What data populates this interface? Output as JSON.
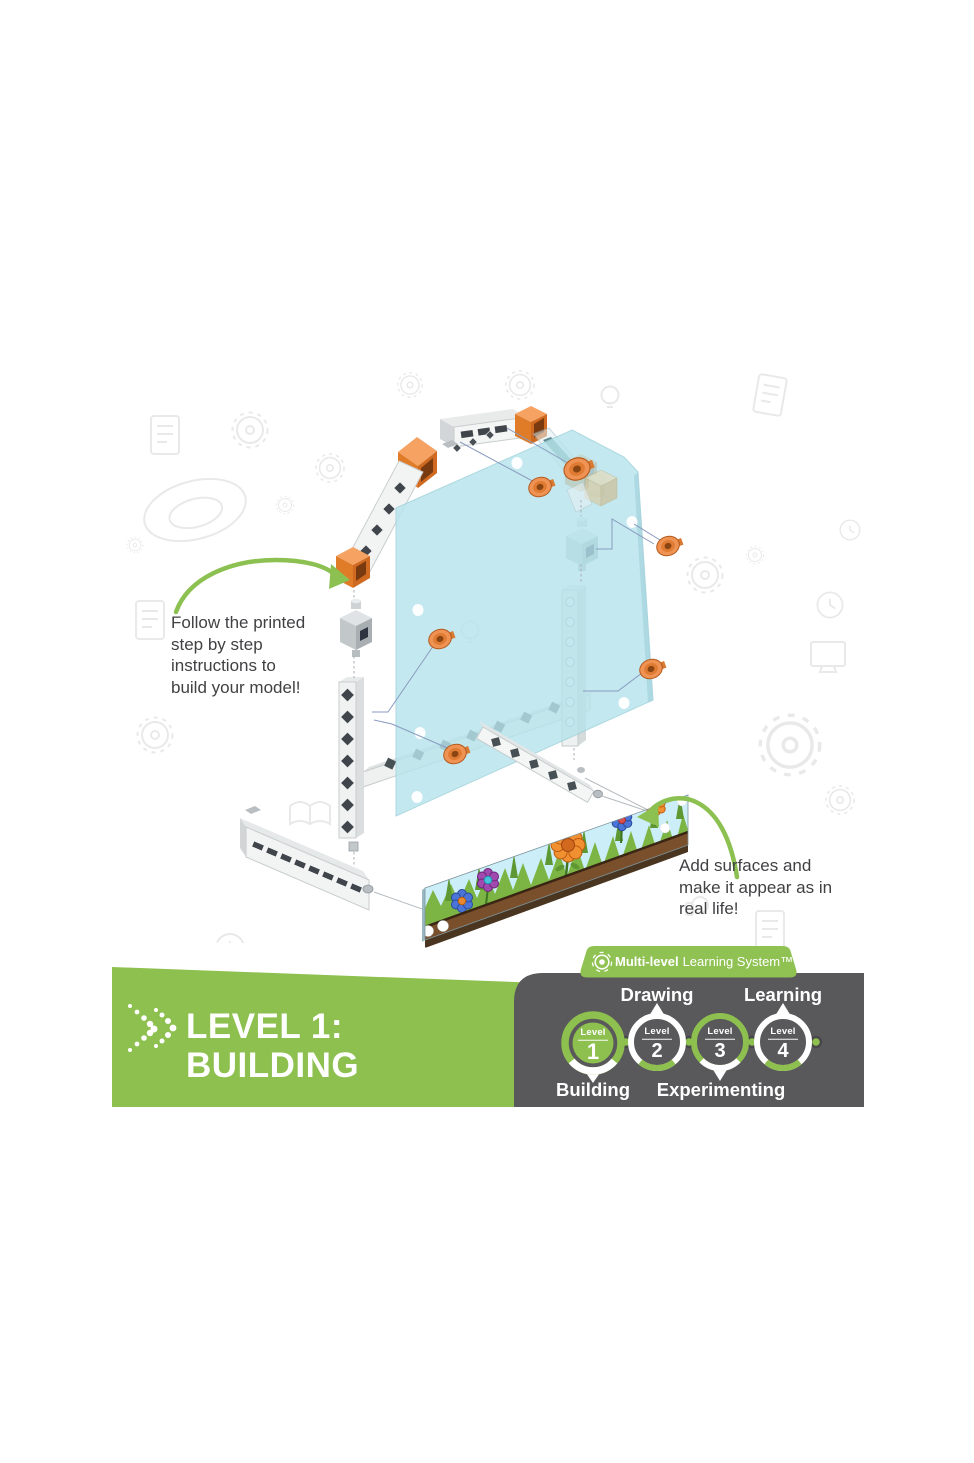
{
  "notes": {
    "left_lines": [
      "Follow the printed",
      "step by step",
      "instructions to",
      "build your model!"
    ],
    "right_lines": [
      "Add surfaces and",
      "make it appear as in",
      "real life!"
    ]
  },
  "banner": {
    "title_line1": "LEVEL 1:",
    "title_line2": "BUILDING"
  },
  "learning_system": {
    "badge_bold": "Multi-level",
    "badge_rest": "Learning System™",
    "labels": {
      "drawing": "Drawing",
      "learning": "Learning",
      "building": "Building",
      "experimenting": "Experimenting"
    },
    "levels": [
      {
        "word": "Level",
        "num": "1"
      },
      {
        "word": "Level",
        "num": "2"
      },
      {
        "word": "Level",
        "num": "3"
      },
      {
        "word": "Level",
        "num": "4"
      }
    ]
  },
  "colors": {
    "green": "#8dc04f",
    "dark_gray": "#59585a",
    "orange": "#ec8c3e",
    "panel_blue": "#b7e4ec",
    "note_text": "#414144"
  },
  "icons": {
    "badge_icon": "gear-target-icon",
    "title_icon": "dotted-chevron-icon"
  }
}
